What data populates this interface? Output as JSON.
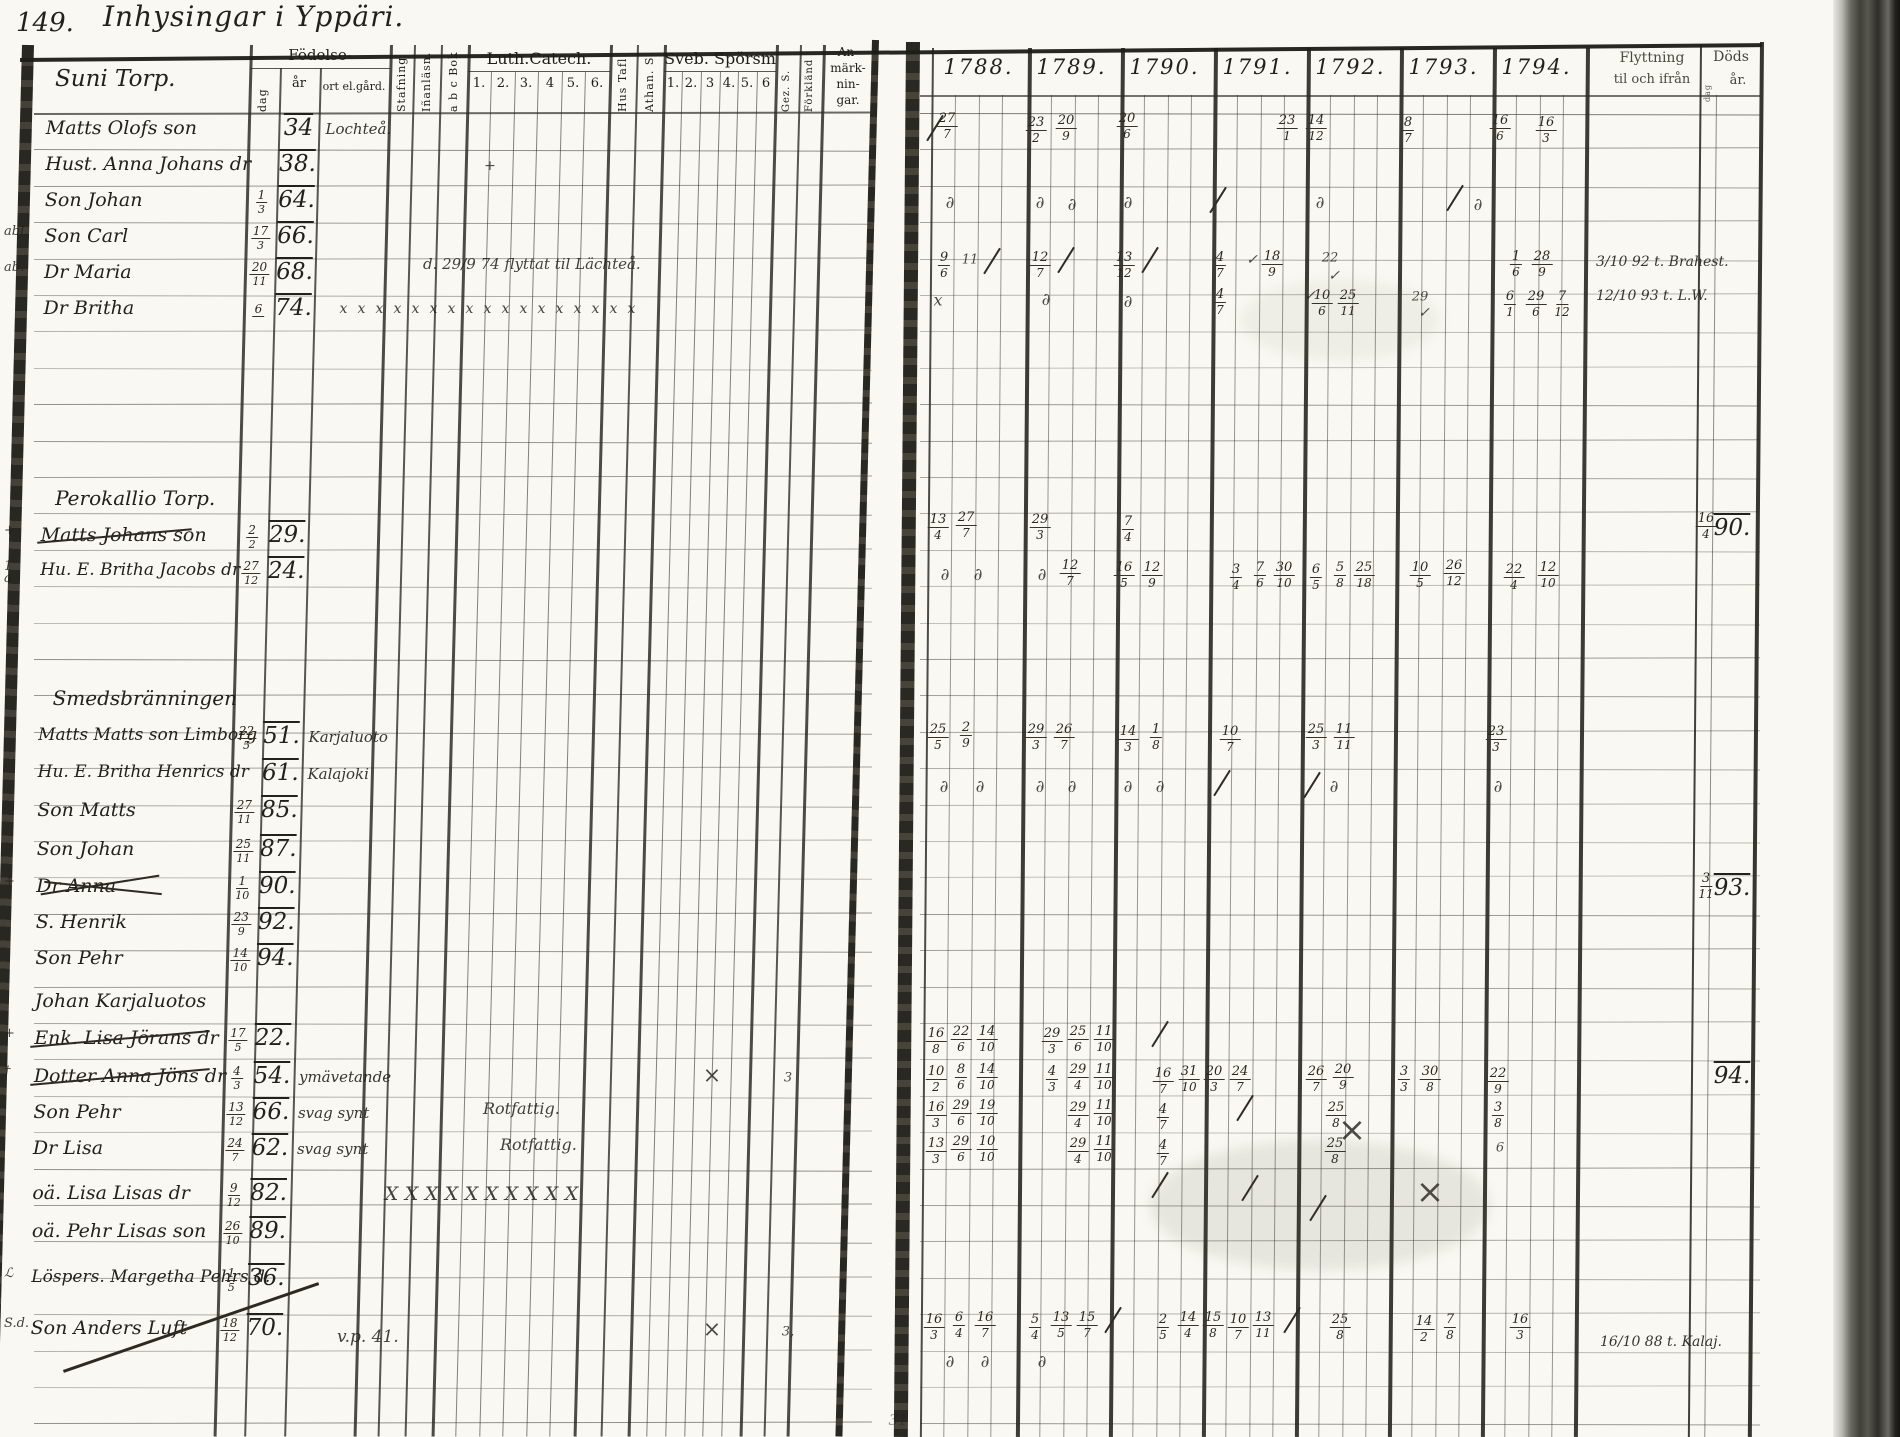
{
  "page": {
    "number": "149.",
    "title": "Inhysingar i Yppäri."
  },
  "colors": {
    "ink": "#23211b",
    "paper": "#f9f8f2",
    "rule": "#2e2d26"
  },
  "left_page": {
    "group_title": "Suni Torp.",
    "header": {
      "birth": {
        "label": "Födelse-",
        "dag": "dag",
        "ar": "år",
        "ort": "ort el.gård."
      },
      "verticals": [
        "Stafning",
        "Iñanläsn.",
        "a b c Bok",
        "Hus Tafl.",
        "Athan. S.",
        "Gez. S.",
        "Förkländ"
      ],
      "luth": {
        "label": "Luth.Catech.",
        "nums": [
          "1.",
          "2.",
          "3.",
          "4",
          "5.",
          "6."
        ]
      },
      "sveb": {
        "label": "Sveb. Spörsm",
        "nums": [
          "1.",
          "2.",
          "3",
          "4.",
          "5.",
          "6"
        ]
      },
      "remarks": [
        "An-",
        "märk-",
        "nin-",
        "gar."
      ]
    },
    "rows": [
      {
        "y": 130,
        "kind": "r",
        "margin": "",
        "name": "Matts Olofs son",
        "strike": 0,
        "dag": "",
        "ar": "34",
        "ort": "Lochteå."
      },
      {
        "y": 166,
        "kind": "r",
        "margin": "",
        "name": "Hust. Anna Johans dr",
        "strike": 0,
        "dag": "",
        "ar": "38.",
        "ort": ""
      },
      {
        "y": 202,
        "kind": "r",
        "margin": "",
        "name": "Son Johan",
        "strike": 0,
        "dag": "1/3",
        "ar": "64.",
        "ort": ""
      },
      {
        "y": 238,
        "kind": "r",
        "margin": "abl.",
        "name": "Son Carl",
        "strike": 0,
        "dag": "17/3",
        "ar": "66.",
        "ort": ""
      },
      {
        "y": 274,
        "kind": "r",
        "margin": "ab.",
        "name": "Dr Maria",
        "strike": 0,
        "dag": "20/11",
        "ar": "68.",
        "ort": ""
      },
      {
        "y": 310,
        "kind": "r",
        "margin": "",
        "name": "Dr Britha",
        "strike": 0,
        "dag": "6",
        "ar": "74.",
        "ort": "",
        "xmarks": {
          "x0": 345,
          "n": 17,
          "st": 18,
          "fs": 14,
          "ch": "x"
        }
      },
      {
        "y": 500,
        "kind": "g",
        "name": "Perokallio Torp."
      },
      {
        "y": 537,
        "kind": "r",
        "margin": "+",
        "name": "Matts Johans son",
        "strike": 1,
        "dag": "2/2",
        "ar": "29.",
        "ort": ""
      },
      {
        "y": 573,
        "kind": "r",
        "margin": "1\na",
        "name": "Hu. E. Britha Jacobs dr",
        "strike": 0,
        "dag": "27/12",
        "ar": "24.",
        "ort": ""
      },
      {
        "y": 700,
        "kind": "g",
        "name": "Smedsbränningen"
      },
      {
        "y": 738,
        "kind": "r",
        "margin": "",
        "name": "Matts Matts son Limborg",
        "strike": 0,
        "dag": "22/5",
        "ar": "51.",
        "ort": "Karjaluoto"
      },
      {
        "y": 775,
        "kind": "r",
        "margin": "",
        "name": "Hu. E. Britha Henrics dr",
        "strike": 0,
        "dag": "",
        "ar": "61.",
        "ort": "Kalajoki"
      },
      {
        "y": 812,
        "kind": "r",
        "margin": "",
        "name": "Son Matts",
        "strike": 0,
        "dag": "27/11",
        "ar": "85.",
        "ort": ""
      },
      {
        "y": 851,
        "kind": "r",
        "margin": "",
        "name": "Son Johan",
        "strike": 0,
        "dag": "25/11",
        "ar": "87.",
        "ort": ""
      },
      {
        "y": 888,
        "kind": "r",
        "margin": "+",
        "name": "Dr Anna",
        "strike": 2,
        "dag": "1/10",
        "ar": "90.",
        "ort": ""
      },
      {
        "y": 924,
        "kind": "r",
        "margin": "",
        "name": "S. Henrik",
        "strike": 0,
        "dag": "23/9",
        "ar": "92.",
        "ort": ""
      },
      {
        "y": 960,
        "kind": "r",
        "margin": "",
        "name": "Son Pehr",
        "strike": 0,
        "dag": "14/10",
        "ar": "94.",
        "ort": ""
      },
      {
        "y": 1003,
        "kind": "r",
        "margin": "",
        "name": "Johan Karjaluotos",
        "strike": 0,
        "dag": "",
        "ar": "",
        "ort": ""
      },
      {
        "y": 1040,
        "kind": "r",
        "margin": "+",
        "name": "Enk. Lisa Jörans dr",
        "strike": 1,
        "dag": "17/5",
        "ar": "22.",
        "ort": ""
      },
      {
        "y": 1078,
        "kind": "r",
        "margin": "†",
        "name": "Dotter Anna Jöns dr",
        "strike": 1,
        "dag": "4/3",
        "ar": "54.",
        "ort": "ymävetande"
      },
      {
        "y": 1114,
        "kind": "r",
        "margin": "",
        "name": "Son Pehr",
        "strike": 0,
        "dag": "13/12",
        "ar": "66.",
        "ort": "svag synt"
      },
      {
        "y": 1150,
        "kind": "r",
        "margin": "",
        "name": "Dr Lisa",
        "strike": 0,
        "dag": "24/7",
        "ar": "62.",
        "ort": "svag synt"
      },
      {
        "y": 1195,
        "kind": "r",
        "margin": "",
        "name": "oä. Lisa Lisas dr",
        "strike": 0,
        "dag": "9/12",
        "ar": "82.",
        "ort": "",
        "xmarks": {
          "x0": 415,
          "n": 10,
          "st": 20,
          "fs": 19,
          "ch": "X"
        }
      },
      {
        "y": 1233,
        "kind": "r",
        "margin": "",
        "name": "oä. Pehr Lisas son",
        "strike": 0,
        "dag": "26/10",
        "ar": "89.",
        "ort": ""
      },
      {
        "y": 1280,
        "kind": "r",
        "margin": "ℒ",
        "name": "Löspers. Margetha Pehrs d.",
        "strike": 0,
        "dag": "1/5",
        "ar": "36.",
        "ort": ""
      },
      {
        "y": 1330,
        "kind": "r",
        "margin": "S.d.",
        "name": "Son Anders Luft",
        "strike": 3,
        "dag": "18/12",
        "ar": "70.",
        "ort": ""
      }
    ],
    "notes": [
      {
        "x": 423,
        "y": 263,
        "t": "d. 29/9 74 flyttat til Lächteå.",
        "fs": 15
      },
      {
        "x": 483,
        "y": 1108,
        "t": "Rotfattig.",
        "fs": 16
      },
      {
        "x": 500,
        "y": 1144,
        "t": "Rotfattig.",
        "fs": 16
      },
      {
        "x": 337,
        "y": 1336,
        "t": "v.p. 41.",
        "fs": 17
      }
    ]
  },
  "right_page": {
    "years": [
      "1788.",
      "1789.",
      "1790.",
      "1791.",
      "1792.",
      "1793.",
      "1794."
    ],
    "moving": {
      "line1": "Flyttning",
      "line2": "til och ifrån"
    },
    "death": {
      "line1": "Döds",
      "line2": "år.",
      "sub": "dag"
    },
    "marks": [
      [
        935,
        128,
        "s"
      ],
      [
        947,
        126,
        "f",
        "27/7"
      ],
      [
        1036,
        130,
        "f",
        "23/2"
      ],
      [
        1066,
        128,
        "f",
        "20/9"
      ],
      [
        1127,
        126,
        "f",
        "20/6"
      ],
      [
        1287,
        128,
        "f",
        "23/1"
      ],
      [
        1316,
        128,
        "f",
        "14/12"
      ],
      [
        1408,
        130,
        "f",
        "8/7"
      ],
      [
        1500,
        128,
        "f",
        "16/6"
      ],
      [
        1546,
        130,
        "f",
        "16/3"
      ],
      [
        950,
        203,
        "d"
      ],
      [
        1040,
        203,
        "d"
      ],
      [
        1072,
        205,
        "d"
      ],
      [
        1128,
        203,
        "d"
      ],
      [
        1218,
        200,
        "s"
      ],
      [
        1320,
        203,
        "d"
      ],
      [
        1455,
        198,
        "s"
      ],
      [
        1478,
        205,
        "d"
      ],
      [
        944,
        265,
        "f",
        "9/6"
      ],
      [
        970,
        260,
        "t",
        "11",
        13
      ],
      [
        992,
        261,
        "s"
      ],
      [
        1040,
        265,
        "f",
        "12/7"
      ],
      [
        1066,
        260,
        "s"
      ],
      [
        1124,
        265,
        "f",
        "13/12"
      ],
      [
        1150,
        260,
        "s"
      ],
      [
        1220,
        265,
        "f",
        "4/7"
      ],
      [
        1252,
        260,
        "c"
      ],
      [
        1272,
        264,
        "f",
        "18/9"
      ],
      [
        1330,
        258,
        "t",
        "22",
        13
      ],
      [
        1334,
        276,
        "c"
      ],
      [
        938,
        300,
        "t",
        "x",
        16
      ],
      [
        1046,
        300,
        "d"
      ],
      [
        1128,
        302,
        "d"
      ],
      [
        1220,
        302,
        "f",
        "4/7"
      ],
      [
        1310,
        296,
        "c"
      ],
      [
        1322,
        303,
        "f",
        "10/6"
      ],
      [
        1348,
        303,
        "f",
        "25/11"
      ],
      [
        1420,
        297,
        "t",
        "29",
        13
      ],
      [
        1424,
        313,
        "c"
      ],
      [
        1516,
        264,
        "f",
        "1/6"
      ],
      [
        1542,
        264,
        "f",
        "28/9"
      ],
      [
        1510,
        304,
        "f",
        "6/1"
      ],
      [
        1536,
        304,
        "f",
        "29/6"
      ],
      [
        1562,
        304,
        "f",
        "7/12"
      ],
      [
        938,
        527,
        "f",
        "13/4"
      ],
      [
        966,
        525,
        "f",
        "27/7"
      ],
      [
        1040,
        527,
        "f",
        "29/3"
      ],
      [
        1128,
        529,
        "f",
        "7/4"
      ],
      [
        945,
        575,
        "d"
      ],
      [
        978,
        575,
        "d"
      ],
      [
        1042,
        575,
        "d"
      ],
      [
        1070,
        573,
        "f",
        "12/7"
      ],
      [
        1124,
        575,
        "f",
        "16/5"
      ],
      [
        1152,
        575,
        "f",
        "12/9"
      ],
      [
        1236,
        577,
        "f",
        "3/4"
      ],
      [
        1260,
        575,
        "f",
        "7/6"
      ],
      [
        1284,
        575,
        "f",
        "30/10"
      ],
      [
        1316,
        577,
        "f",
        "6/5"
      ],
      [
        1340,
        575,
        "f",
        "5/8"
      ],
      [
        1364,
        575,
        "f",
        "25/18"
      ],
      [
        1420,
        575,
        "f",
        "10/5"
      ],
      [
        1454,
        573,
        "f",
        "26/12"
      ],
      [
        1514,
        577,
        "f",
        "22/4"
      ],
      [
        1548,
        575,
        "f",
        "12/10"
      ],
      [
        938,
        737,
        "f",
        "25/5"
      ],
      [
        966,
        735,
        "f",
        "2/9"
      ],
      [
        1036,
        737,
        "f",
        "29/3"
      ],
      [
        1064,
        737,
        "f",
        "26/7"
      ],
      [
        1128,
        739,
        "f",
        "14/3"
      ],
      [
        1156,
        737,
        "f",
        "1/8"
      ],
      [
        1230,
        739,
        "f",
        "10/7"
      ],
      [
        1316,
        737,
        "f",
        "25/3"
      ],
      [
        1344,
        737,
        "f",
        "11/11"
      ],
      [
        1496,
        739,
        "f",
        "23/3"
      ],
      [
        944,
        787,
        "d"
      ],
      [
        980,
        787,
        "d"
      ],
      [
        1040,
        787,
        "d"
      ],
      [
        1072,
        787,
        "d"
      ],
      [
        1128,
        787,
        "d"
      ],
      [
        1160,
        787,
        "d"
      ],
      [
        1222,
        783,
        "s"
      ],
      [
        1312,
        785,
        "s"
      ],
      [
        1334,
        787,
        "d"
      ],
      [
        1498,
        787,
        "d"
      ],
      [
        936,
        1041,
        "f",
        "16/8"
      ],
      [
        961,
        1039,
        "f",
        "22/6"
      ],
      [
        987,
        1039,
        "f",
        "14/10"
      ],
      [
        1052,
        1041,
        "f",
        "29/3"
      ],
      [
        1078,
        1039,
        "f",
        "25/6"
      ],
      [
        1104,
        1039,
        "f",
        "11/10"
      ],
      [
        1160,
        1034,
        "s"
      ],
      [
        936,
        1079,
        "f",
        "10/2"
      ],
      [
        961,
        1077,
        "f",
        "8/6"
      ],
      [
        987,
        1077,
        "f",
        "14/10"
      ],
      [
        1052,
        1079,
        "f",
        "4/3"
      ],
      [
        1078,
        1077,
        "f",
        "29/4"
      ],
      [
        1104,
        1077,
        "f",
        "11/10"
      ],
      [
        1163,
        1081,
        "f",
        "16/7"
      ],
      [
        1189,
        1079,
        "f",
        "31/10"
      ],
      [
        1214,
        1079,
        "f",
        "20/3"
      ],
      [
        1240,
        1079,
        "f",
        "24/7"
      ],
      [
        1316,
        1079,
        "f",
        "26/7"
      ],
      [
        1343,
        1077,
        "f",
        "20/9"
      ],
      [
        1404,
        1079,
        "f",
        "3/3"
      ],
      [
        1430,
        1079,
        "f",
        "30/8"
      ],
      [
        1498,
        1081,
        "f",
        "22/9"
      ],
      [
        936,
        1115,
        "f",
        "16/3"
      ],
      [
        961,
        1113,
        "f",
        "29/6"
      ],
      [
        987,
        1113,
        "f",
        "19/10"
      ],
      [
        1078,
        1115,
        "f",
        "29/4"
      ],
      [
        1104,
        1113,
        "f",
        "11/10"
      ],
      [
        1163,
        1117,
        "f",
        "4/7"
      ],
      [
        1336,
        1115,
        "f",
        "25/8"
      ],
      [
        1498,
        1115,
        "f",
        "3/8"
      ],
      [
        936,
        1151,
        "f",
        "13/3"
      ],
      [
        961,
        1149,
        "f",
        "29/6"
      ],
      [
        987,
        1149,
        "f",
        "10/10"
      ],
      [
        1078,
        1151,
        "f",
        "29/4"
      ],
      [
        1104,
        1149,
        "f",
        "11/10"
      ],
      [
        1163,
        1153,
        "f",
        "4/7"
      ],
      [
        1335,
        1151,
        "f",
        "25/8"
      ],
      [
        1500,
        1148,
        "t",
        "6",
        13
      ],
      [
        1245,
        1108,
        "s"
      ],
      [
        1352,
        1130,
        "x"
      ],
      [
        1160,
        1185,
        "s"
      ],
      [
        1250,
        1188,
        "s"
      ],
      [
        1430,
        1192,
        "x"
      ],
      [
        1318,
        1208,
        "s"
      ],
      [
        934,
        1327,
        "f",
        "16/3"
      ],
      [
        959,
        1325,
        "f",
        "6/4"
      ],
      [
        985,
        1325,
        "f",
        "16/7"
      ],
      [
        1035,
        1327,
        "f",
        "5/4"
      ],
      [
        1061,
        1325,
        "f",
        "13/5"
      ],
      [
        1087,
        1325,
        "f",
        "15/7"
      ],
      [
        1113,
        1320,
        "s"
      ],
      [
        1163,
        1327,
        "f",
        "2/5"
      ],
      [
        1188,
        1325,
        "f",
        "14/4"
      ],
      [
        1213,
        1325,
        "f",
        "15/8"
      ],
      [
        1238,
        1327,
        "f",
        "10/7"
      ],
      [
        1263,
        1325,
        "f",
        "13/11"
      ],
      [
        1292,
        1320,
        "s"
      ],
      [
        1340,
        1327,
        "f",
        "25/8"
      ],
      [
        1424,
        1329,
        "f",
        "14/2"
      ],
      [
        1450,
        1327,
        "f",
        "7/8"
      ],
      [
        1520,
        1327,
        "f",
        "16/3"
      ],
      [
        950,
        1362,
        "d"
      ],
      [
        985,
        1362,
        "d"
      ],
      [
        1042,
        1362,
        "d"
      ],
      [
        1706,
        526,
        "f",
        "16/4"
      ],
      [
        1732,
        528,
        "y",
        "90."
      ],
      [
        1706,
        886,
        "f",
        "3/11"
      ],
      [
        1732,
        888,
        "y",
        "93."
      ],
      [
        1732,
        1076,
        "y",
        "94."
      ],
      [
        1596,
        262,
        "n",
        "3/10 92 t. Brahest."
      ],
      [
        1596,
        296,
        "n",
        "12/10 93 t. L.W."
      ],
      [
        1600,
        1342,
        "n",
        "16/10 88 t. Kalaj."
      ],
      [
        490,
        166,
        "t",
        "+",
        14
      ],
      [
        712,
        1076,
        "t",
        "×",
        22
      ],
      [
        788,
        1078,
        "t",
        "3",
        13
      ],
      [
        712,
        1330,
        "t",
        "×",
        22
      ],
      [
        788,
        1332,
        "t",
        "3,",
        13
      ],
      [
        898,
        1420,
        "t",
        "31",
        15,
        0.45
      ]
    ]
  }
}
